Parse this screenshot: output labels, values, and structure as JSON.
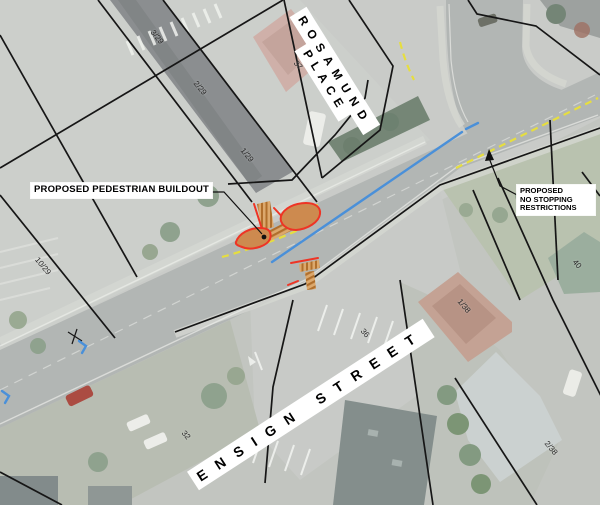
{
  "map": {
    "annotations": {
      "buildout_label": "PROPOSED PEDESTRIAN BUILDOUT",
      "no_stopping_label": "PROPOSED\nNO STOPPING\nRESTRICTIONS"
    },
    "street_labels": [
      {
        "id": "ensign-street",
        "text": "ENSIGN STREET",
        "x": 193,
        "y": 470,
        "rotate": -33,
        "font": 14,
        "spacing": 12
      },
      {
        "id": "rosamund",
        "text": "ROSAMUND",
        "x": 298,
        "y": 2,
        "rotate": 58,
        "font": 12,
        "spacing": 7
      },
      {
        "id": "place",
        "text": "PLACE",
        "x": 303,
        "y": 36,
        "rotate": 58,
        "font": 12,
        "spacing": 6
      }
    ],
    "parcel_labels": [
      {
        "text": "3/29",
        "x": 157,
        "y": 37
      },
      {
        "text": "2/29",
        "x": 200,
        "y": 88
      },
      {
        "text": "1/29",
        "x": 247,
        "y": 155
      },
      {
        "text": "10/29",
        "x": 43,
        "y": 266
      },
      {
        "text": "37",
        "x": 298,
        "y": 65
      },
      {
        "text": "40",
        "x": 577,
        "y": 264
      },
      {
        "text": "1/38",
        "x": 464,
        "y": 306
      },
      {
        "text": "2/38",
        "x": 551,
        "y": 448
      },
      {
        "text": "36",
        "x": 365,
        "y": 333
      },
      {
        "text": "32",
        "x": 186,
        "y": 435
      }
    ],
    "colors": {
      "buildout_fill": "#cd8a4f",
      "proposed_red": "#ee3425",
      "no_stopping_yellow": "#e6de3f",
      "existing_blue": "#4a90d9"
    }
  }
}
